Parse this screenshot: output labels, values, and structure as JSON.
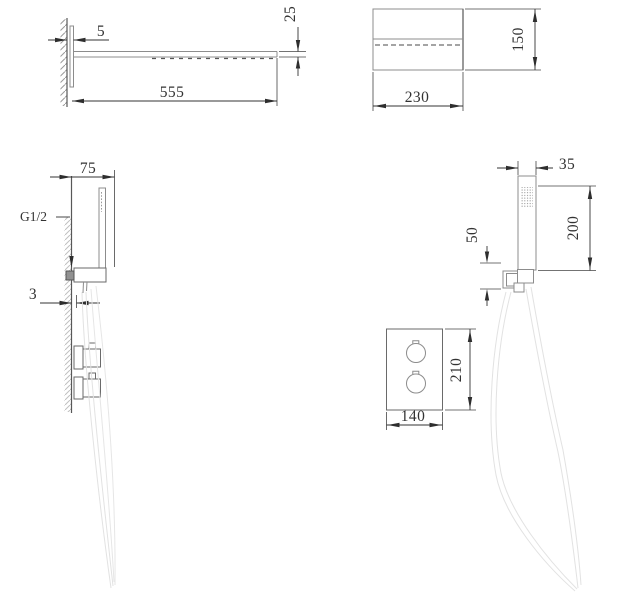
{
  "drawing": {
    "background": "#ffffff",
    "outline_color": "#8c8c8c",
    "dimension_color": "#333333",
    "hose_color": "#e2e2e2",
    "hatch_color": "#bdbdbd"
  },
  "head_side_view": {
    "dim_plate_thickness": "5",
    "dim_length": "555",
    "dim_height": "25"
  },
  "head_front_view": {
    "dim_width": "230",
    "dim_height": "150"
  },
  "hand_shower_side_view": {
    "dim_wall_offset": "75",
    "thread_label": "G1/2",
    "dim_plate_thickness": "3"
  },
  "hand_shower_front_view": {
    "dim_width": "35",
    "dim_length": "200",
    "dim_holder_height": "50"
  },
  "valve_front_view": {
    "dim_width": "140",
    "dim_height": "210"
  }
}
